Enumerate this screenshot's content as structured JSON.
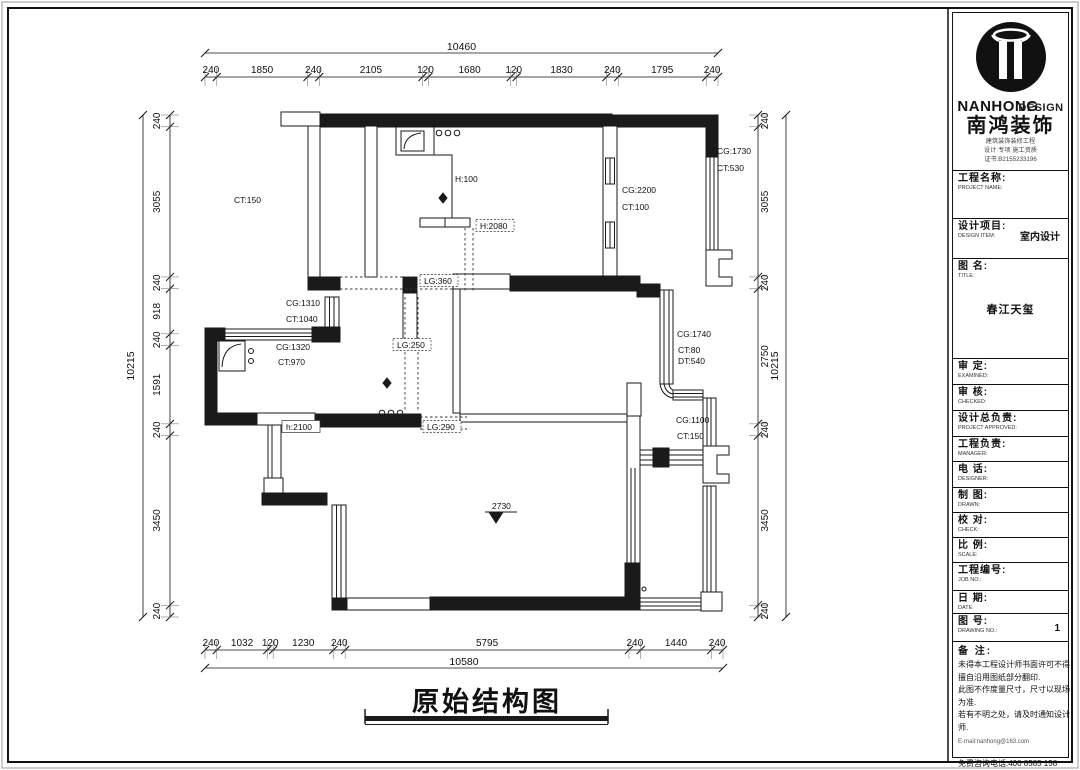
{
  "drawing": {
    "title": "原始结构图",
    "level_marker": "2730",
    "dims": {
      "top": {
        "total": "10460",
        "segments": [
          "240",
          "1850",
          "240",
          "2105",
          "120",
          "1680",
          "120",
          "1830",
          "240",
          "1795",
          "240"
        ]
      },
      "bottom": {
        "total": "10580",
        "segments": [
          "240",
          "1032",
          "120",
          "1230",
          "240",
          "5795",
          "240",
          "1440",
          "240"
        ]
      },
      "left": {
        "total": "10215",
        "segments": [
          "240",
          "3055",
          "240",
          "918",
          "240",
          "1591",
          "240",
          "3450",
          "240"
        ]
      },
      "right": {
        "total": "10215",
        "segments": [
          "240",
          "3055",
          "240",
          "2750",
          "240",
          "3450",
          "240"
        ]
      }
    },
    "annotations": [
      {
        "t": "CT:150",
        "x": 234,
        "y": 203
      },
      {
        "t": "H:100",
        "x": 455,
        "y": 182
      },
      {
        "t": "H:2080",
        "x": 480,
        "y": 229,
        "box": "dashed"
      },
      {
        "t": "CG:2200",
        "x": 622,
        "y": 193
      },
      {
        "t": "CT:100",
        "x": 622,
        "y": 210
      },
      {
        "t": "CG:1730",
        "x": 717,
        "y": 154
      },
      {
        "t": "CT:530",
        "x": 717,
        "y": 171
      },
      {
        "t": "LG:360",
        "x": 424,
        "y": 284,
        "box": "dashed"
      },
      {
        "t": "CG:1310",
        "x": 286,
        "y": 306
      },
      {
        "t": "CT:1040",
        "x": 286,
        "y": 322
      },
      {
        "t": "CG:1320",
        "x": 276,
        "y": 350
      },
      {
        "t": "CT:970",
        "x": 278,
        "y": 365
      },
      {
        "t": "LG:250",
        "x": 397,
        "y": 348,
        "box": "dashed"
      },
      {
        "t": "h:2100",
        "x": 286,
        "y": 430,
        "box": "solid"
      },
      {
        "t": "LG:290",
        "x": 427,
        "y": 430,
        "box": "dashed"
      },
      {
        "t": "CG:1740",
        "x": 677,
        "y": 337
      },
      {
        "t": "CT:80",
        "x": 678,
        "y": 353
      },
      {
        "t": "DT:540",
        "x": 678,
        "y": 364
      },
      {
        "t": "CG:1100",
        "x": 676,
        "y": 423
      },
      {
        "t": "CT:150",
        "x": 677,
        "y": 439
      },
      {
        "t": "2730",
        "x": 492,
        "y": 509
      }
    ]
  },
  "titleblock": {
    "brand": {
      "en1": "NANHONG",
      "en2": "DESIGN",
      "cn": "南鸿装饰",
      "sub1": "建筑装饰装修工程",
      "sub2": "设计·专项 施工资质",
      "sub3": "证书:B2155233196"
    },
    "rows": [
      {
        "id": "project-name",
        "cn": "工程名称:",
        "en": "PROJECT NAME:",
        "value": "",
        "h": 48
      },
      {
        "id": "design-item",
        "cn": "设计项目:",
        "en": "DESIGN ITEM:",
        "value": "室内设计",
        "h": 40,
        "vpos": "right"
      },
      {
        "id": "drawing-title",
        "cn": "图 名:",
        "en": "TITLE:",
        "value": "春江天玺",
        "h": 100,
        "vpos": "below"
      },
      {
        "id": "examined",
        "cn": "审 定:",
        "en": "EXAMINED:",
        "value": "",
        "h": 26
      },
      {
        "id": "checked",
        "cn": "审 核:",
        "en": "CHECKED:",
        "value": "",
        "h": 26
      },
      {
        "id": "project-approved",
        "cn": "设计总负责:",
        "en": "PROJECT APPROVED:",
        "value": "",
        "h": 26
      },
      {
        "id": "manager",
        "cn": "工程负责:",
        "en": "MANAGER:",
        "value": "",
        "h": 25
      },
      {
        "id": "designer",
        "cn": "电 话:",
        "en": "DESIGNER:",
        "value": "",
        "h": 26
      },
      {
        "id": "drawn",
        "cn": "制 图:",
        "en": "DRAWN:",
        "value": "",
        "h": 25
      },
      {
        "id": "check",
        "cn": "校 对:",
        "en": "CHECK:",
        "value": "",
        "h": 25
      },
      {
        "id": "scale",
        "cn": "比 例:",
        "en": "SCALE:",
        "value": "",
        "h": 25
      },
      {
        "id": "job-no",
        "cn": "工程编号:",
        "en": "JOB NO.:",
        "value": "",
        "h": 28
      },
      {
        "id": "date",
        "cn": "日 期:",
        "en": "DATE:",
        "value": "",
        "h": 23
      },
      {
        "id": "drawing-no",
        "cn": "图 号:",
        "en": "DRAWING NO.:",
        "value": "1",
        "h": 28,
        "vpos": "right"
      }
    ],
    "notes": {
      "label": "备 注:",
      "lines": [
        "未得本工程设计师书面许可不得",
        "擅自沿用图纸部分翻印.",
        "此图不作度量尺寸，尺寸以现场",
        "为准.",
        "若有不明之处，请及时通知设计",
        "师.",
        "E-mail:nanhong@163.com"
      ],
      "phone": "免费咨询电话:400 8585 158"
    }
  }
}
